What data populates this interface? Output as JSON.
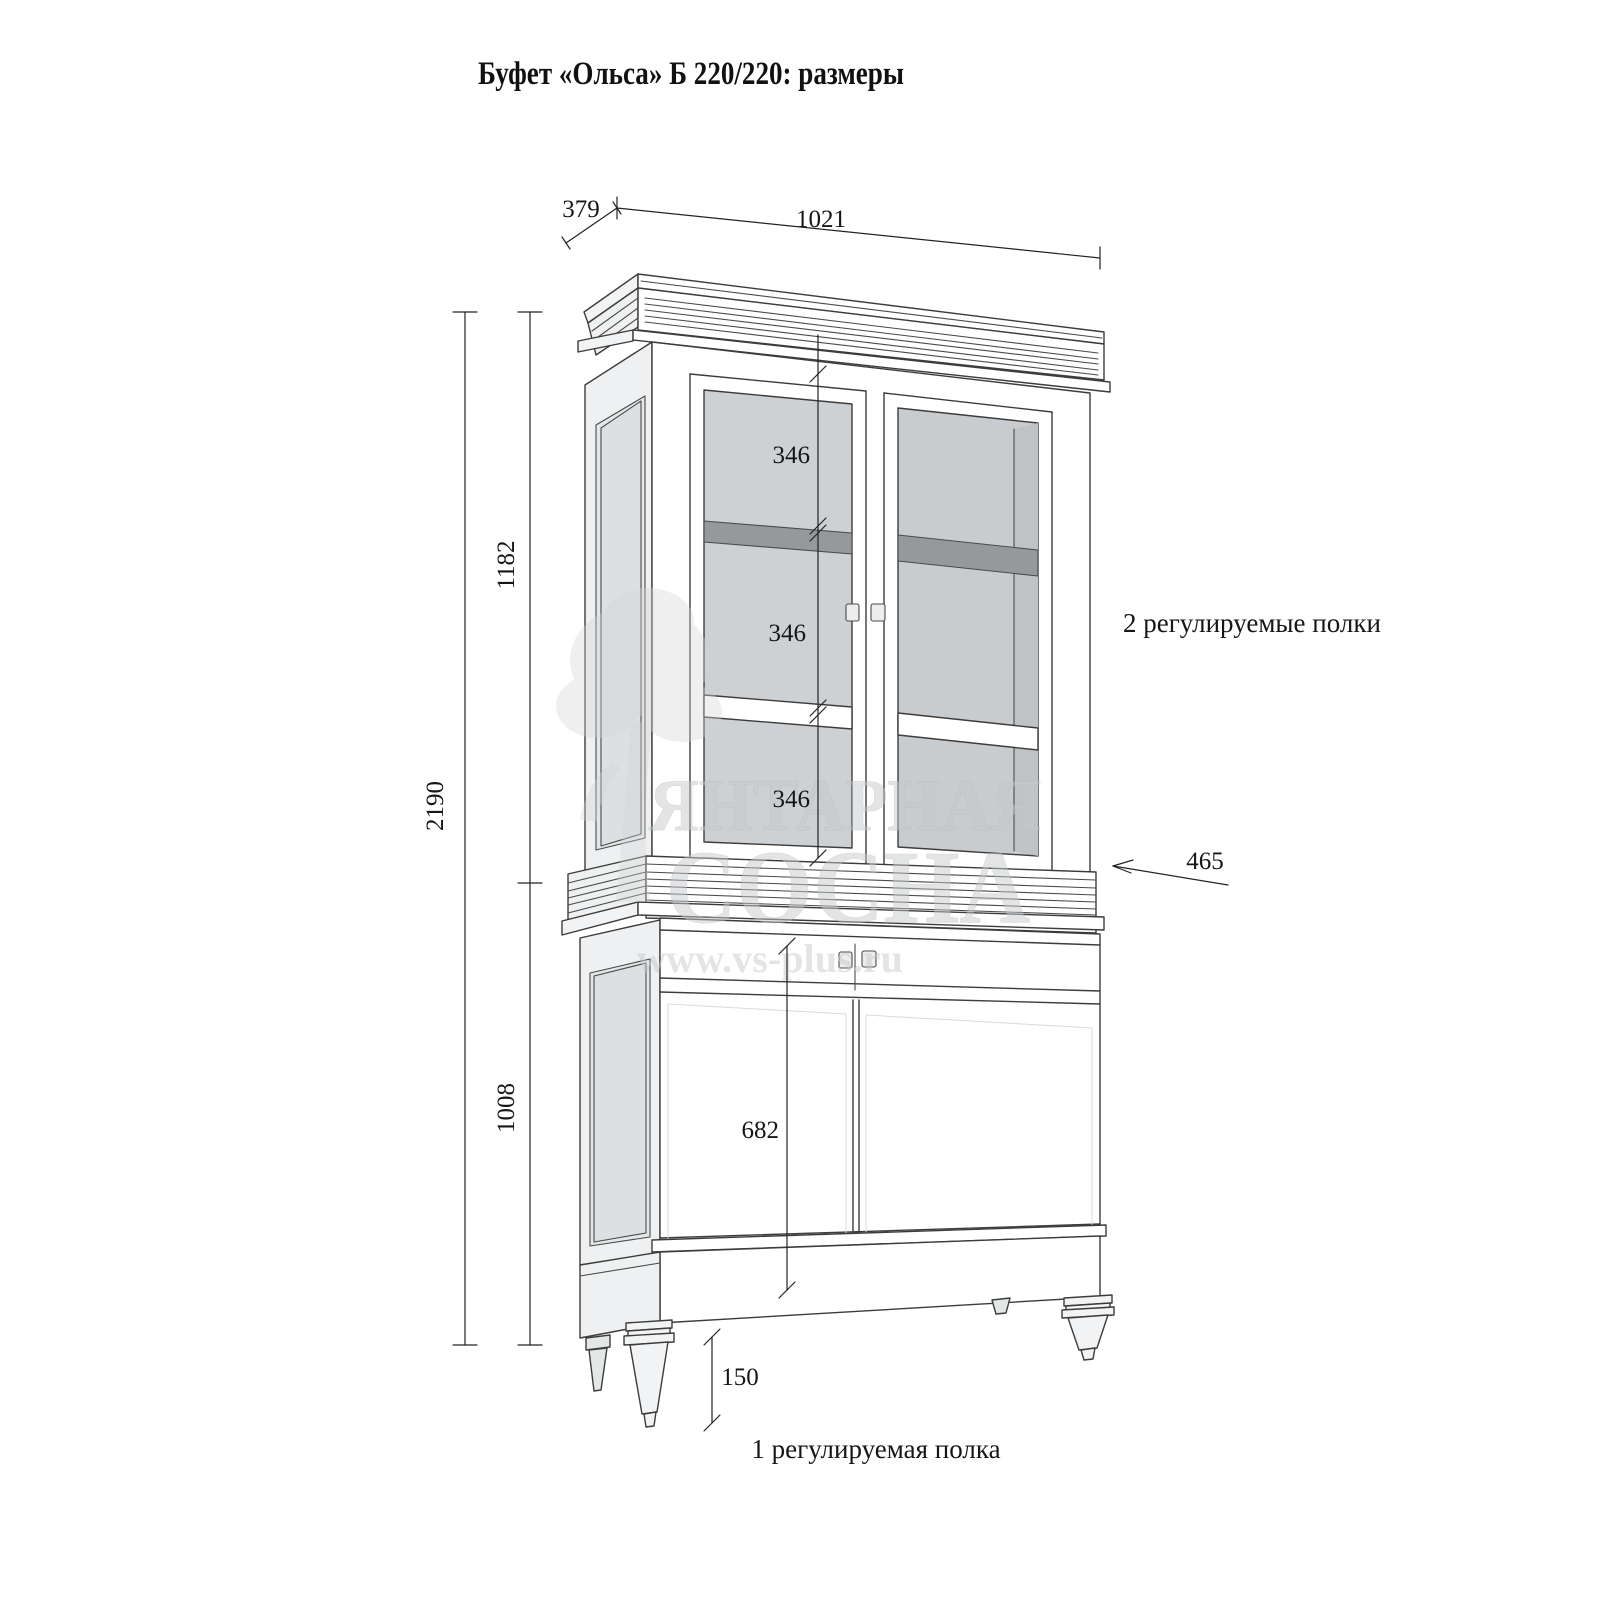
{
  "title": "Буфет «Ольса» Б 220/220: размеры",
  "dimensions": {
    "top_depth": "379",
    "top_width": "1021",
    "total_height": "2190",
    "upper_height": "1182",
    "lower_height": "1008",
    "shelf_gap_top": "346",
    "shelf_gap_middle": "346",
    "shelf_gap_bottom": "346",
    "lower_inner_height": "682",
    "lower_depth": "465",
    "leg_height": "150"
  },
  "annotations": {
    "upper_shelves_note": "2 регулируемые полки",
    "lower_shelf_note": "1 регулируемая полка"
  },
  "watermark": {
    "line1": "ЯНТАРНАЯ",
    "line2": "СОСНА",
    "url": "www.vs-plus.ru"
  },
  "colors": {
    "background": "#ffffff",
    "line": "#3c3c3c",
    "dimension_line": "#232323",
    "text": "#161616",
    "glass": "#cdd1d3",
    "interior": "#c8ccce",
    "shelf_edge": "#96999b",
    "side_panel": "#eef0f1",
    "watermark": "#c7c9ca"
  }
}
